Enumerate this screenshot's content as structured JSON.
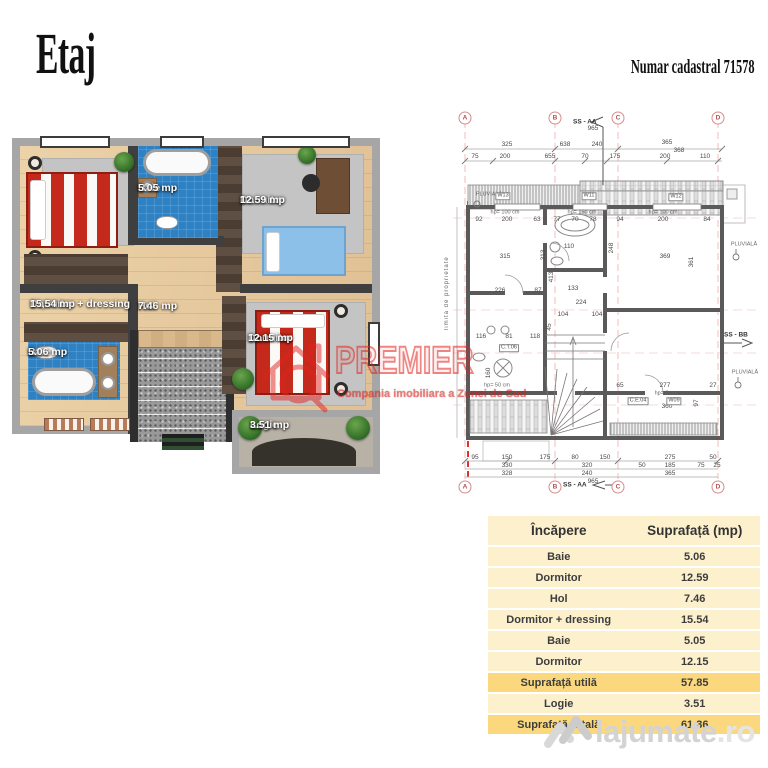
{
  "header": {
    "title": "Etaj",
    "cadastral": "Numar cadastral 71578"
  },
  "plan3d": {
    "rooms": {
      "dormitor_dressing": {
        "name": "Dormitor + dressing",
        "area": "15,54 mp"
      },
      "baie_top": {
        "name": "Baie",
        "area": "5.05 mp"
      },
      "dormitor_top": {
        "name": "Dormitor",
        "area": "12.59 mp"
      },
      "hol": {
        "name": "Hol",
        "area": "7.46 mp"
      },
      "baie_bottom": {
        "name": "Baie",
        "area": "5.06 mp"
      },
      "dormitor_bottom": {
        "name": "Dormitor",
        "area": "12.15 mp"
      },
      "logie": {
        "name": "Logie",
        "area": "3.51 mp"
      }
    },
    "colors": {
      "bath_tile": "#2e81c3",
      "bed_red": "#c5291b",
      "bed_blue": "#8cc0e9",
      "floor_wood": "#e6c69e",
      "wall_dark": "#3f3f3f",
      "wall_light": "#a6a6a6"
    }
  },
  "tech": {
    "markers": [
      "A",
      "B",
      "C",
      "D"
    ],
    "section_aa": "SS - AA",
    "section_bb": "SS - BB",
    "property_line": "limita de proprietate",
    "pluviala": "PLUVIALĂ",
    "windows": [
      "W13",
      "W11",
      "W12"
    ],
    "boxed": [
      "C.T.06",
      "C.E.04",
      "W09"
    ],
    "hp_left": "hp= 100 cm",
    "hp_mid": "hp= 150 cm",
    "hp_right": "hp= 100 cm",
    "hp_lower": "hp= 50 cm",
    "hp_zero": "hp= 0 cm",
    "dim_965_top": "965",
    "dim_965_bottom": "965",
    "dim_368": "368",
    "dims_top1": [
      "325",
      "638",
      "240",
      "365"
    ],
    "dims_top2": [
      "75",
      "200",
      "655",
      "70",
      "175",
      "200",
      "110"
    ],
    "dims_left": [
      "92",
      "200",
      "63",
      "315",
      "226",
      "87",
      "313",
      "413"
    ],
    "dims_bath": [
      "77",
      "70",
      "78",
      "110",
      "133"
    ],
    "dims_right": [
      "94",
      "200",
      "84",
      "369",
      "361",
      "248"
    ],
    "dims_stairs": [
      "224",
      "104",
      "104",
      "45"
    ],
    "dims_lower_left": [
      "116",
      "81",
      "118",
      "160"
    ],
    "dims_lower_right": [
      "65",
      "277",
      "27",
      "360",
      "97"
    ],
    "dims_bottom1": [
      "95",
      "150",
      "175",
      "80",
      "150",
      "275",
      "50"
    ],
    "dims_bottom2": [
      "330",
      "320",
      "50",
      "185",
      "75",
      "25"
    ],
    "dims_bottom3": [
      "328",
      "240",
      "365"
    ]
  },
  "watermark": {
    "brand": "PREMIER",
    "tagline": "Compania imobiliara a Zonei de Sud",
    "color": "#e2231e"
  },
  "table": {
    "headers": [
      "Încăpere",
      "Suprafață (mp)"
    ],
    "rows": [
      {
        "label": "Baie",
        "value": "5.06",
        "highlight": false
      },
      {
        "label": "Dormitor",
        "value": "12.59",
        "highlight": false
      },
      {
        "label": "Hol",
        "value": "7.46",
        "highlight": false
      },
      {
        "label": "Dormitor + dressing",
        "value": "15.54",
        "highlight": false
      },
      {
        "label": "Baie",
        "value": "5.05",
        "highlight": false
      },
      {
        "label": "Dormitor",
        "value": "12.15",
        "highlight": false
      },
      {
        "label": "Suprafață utilă",
        "value": "57.85",
        "highlight": true
      },
      {
        "label": "Logie",
        "value": "3.51",
        "highlight": false
      },
      {
        "label": "Suprafață totală",
        "value": "61.36",
        "highlight": true
      }
    ]
  },
  "site_watermark": {
    "name": "lajumate",
    "tld": ".ro"
  }
}
